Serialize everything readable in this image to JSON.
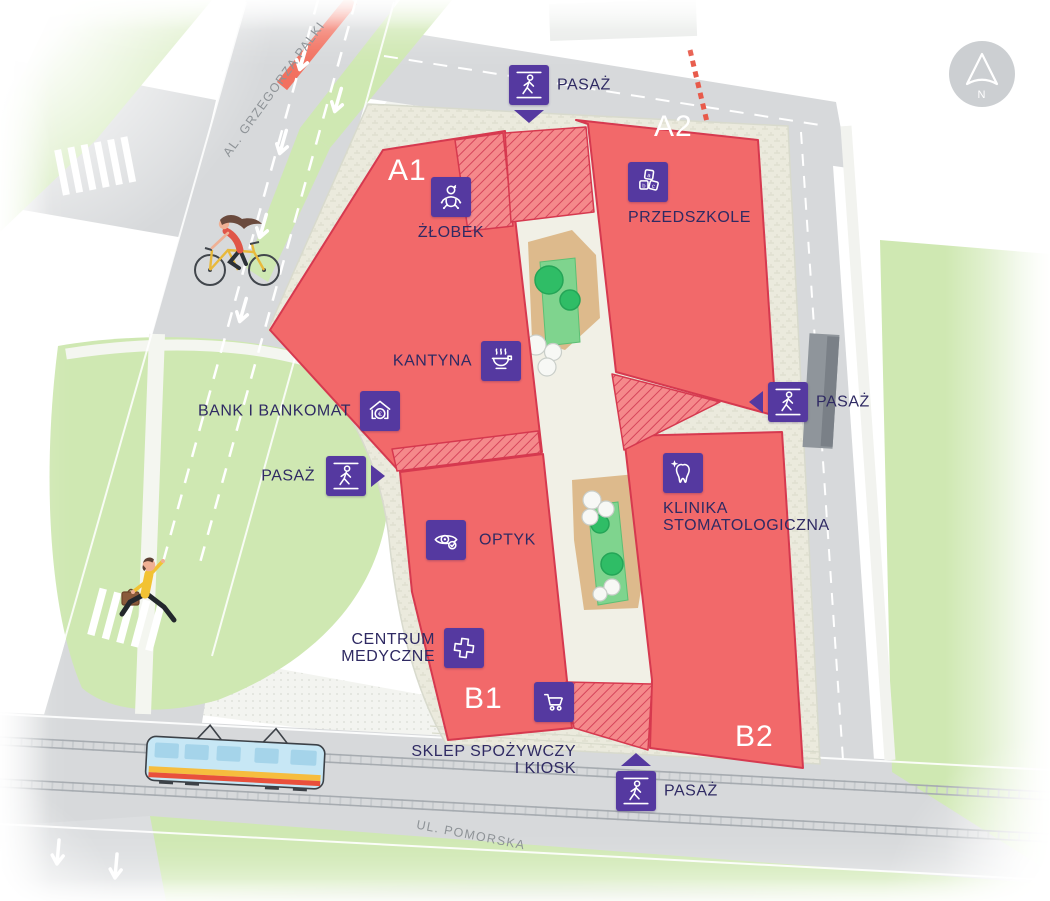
{
  "map": {
    "north_label": "N",
    "streets": {
      "left": "AL. GRZEGORZA PALKI",
      "bottom": "UL. POMORSKA"
    },
    "buildings": [
      {
        "id": "A1"
      },
      {
        "id": "A2"
      },
      {
        "id": "B1"
      },
      {
        "id": "B2"
      }
    ],
    "markers": [
      {
        "id": "pasaz-top",
        "label": "PASAŻ",
        "icon": "walker-icon",
        "arrow": "down"
      },
      {
        "id": "zlobek",
        "label": "ŻŁOBEK",
        "icon": "baby-icon",
        "arrow": ""
      },
      {
        "id": "przedszkole",
        "label": "PRZEDSZKOLE",
        "icon": "abc-blocks-icon",
        "arrow": ""
      },
      {
        "id": "kantyna",
        "label": "KANTYNA",
        "icon": "food-bowl-icon",
        "arrow": ""
      },
      {
        "id": "bank-i-bankom",
        "label": "BANK I BANKOMAT",
        "icon": "bank-icon",
        "arrow": ""
      },
      {
        "id": "pasaz-left",
        "label": "PASAŻ",
        "icon": "walker-icon",
        "arrow": "right"
      },
      {
        "id": "optyk",
        "label": "OPTYK",
        "icon": "eye-icon",
        "arrow": ""
      },
      {
        "id": "klinika-stomatologiczna",
        "lines": [
          "KLINIKA",
          "STOMATOLOGICZNA"
        ],
        "icon": "tooth-icon",
        "arrow": ""
      },
      {
        "id": "centrum-medyczne",
        "lines": [
          "CENTRUM",
          "MEDYCZNE"
        ],
        "icon": "medical-cross-icon",
        "arrow": ""
      },
      {
        "id": "sklep-spozywczy",
        "lines": [
          "SKLEP SPOŻYWCZY",
          "I KIOSK"
        ],
        "icon": "shopping-cart-icon",
        "arrow": ""
      },
      {
        "id": "pasaz-bottom",
        "label": "PASAŻ",
        "icon": "walker-icon",
        "arrow": "up"
      },
      {
        "id": "pasaz-right",
        "label": "PASAŻ",
        "icon": "walker-icon",
        "arrow": "left"
      }
    ],
    "icons": {
      "abc_letters": [
        "a",
        "b",
        "c"
      ],
      "euro_symbol": "€"
    },
    "colors": {
      "building_fill": "#f2696a",
      "building_outline": "#d6394f",
      "hatch_fill": "#f5898b",
      "marker_purple": "#5539a0",
      "label_text": "#2f2a63",
      "street_label": "#8e9397",
      "park_green": "#cfe8b2",
      "road_gray": "#d7d9db",
      "parcel_beige": "#ebeadd",
      "sand_tan": "#ddba8c",
      "tree_green": "#2fbd66"
    }
  }
}
